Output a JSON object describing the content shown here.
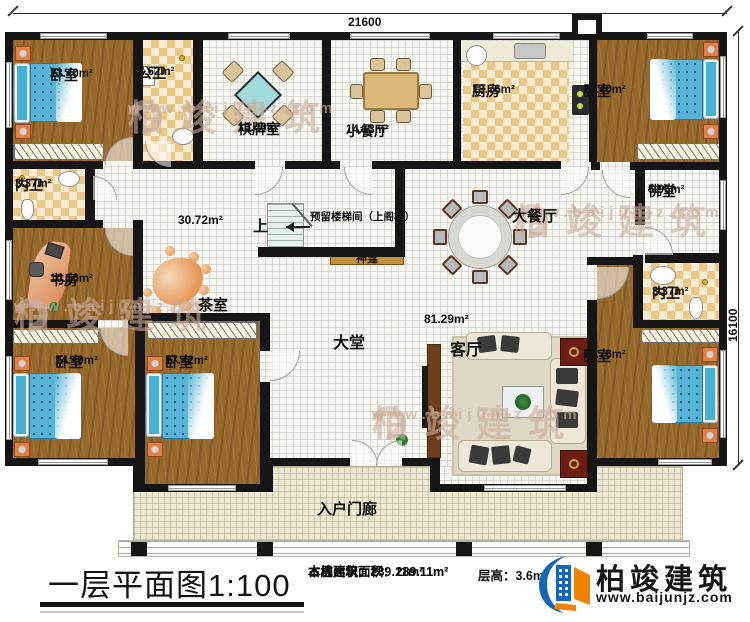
{
  "plan": {
    "dim_top": "21600",
    "dim_right": "16100",
    "up_label": "上",
    "stair_note": "预留楼梯间（上阁楼）",
    "open_area_label": "30.72m²",
    "living_area_label": "81.29m²"
  },
  "rooms": {
    "bedroom_tl": {
      "name": "卧室",
      "area": "13.40m²"
    },
    "public_bath": {
      "name": "公卫",
      "area": "3.62m²"
    },
    "chess_room": {
      "name": "棋牌室",
      "area": "13.40m²"
    },
    "small_dining": {
      "name": "小餐厅",
      "area": "14.13m²"
    },
    "kitchen": {
      "name": "厨房",
      "area": "13.76m²"
    },
    "bedroom_tr": {
      "name": "卧室",
      "area": "13.40m²"
    },
    "inner_bath_left": {
      "name": "内卫",
      "area": "3.37m²"
    },
    "study": {
      "name": "书房",
      "area": "10.10m²"
    },
    "tea_room": {
      "name": "茶室"
    },
    "shrine": {
      "name": "神龛"
    },
    "big_dining": {
      "name": "大餐厅"
    },
    "buddha_hall": {
      "name": "佛堂",
      "area": "5.96m²"
    },
    "inner_bath_right": {
      "name": "内卫",
      "area": "3.37m²"
    },
    "bedroom_bl": {
      "name": "卧室",
      "area": "14.49m²"
    },
    "bedroom_bm": {
      "name": "卧室",
      "area": "17.42m²"
    },
    "bedroom_br": {
      "name": "卧室",
      "area": "16.76m²"
    },
    "lobby": {
      "name": "大堂"
    },
    "living": {
      "name": "客厅"
    },
    "porch": {
      "name": "入户门廊"
    }
  },
  "footer": {
    "title": "一层平面图1:100",
    "stats": [
      "本层建筑面积：289.11m²",
      "本栋建筑面积：289.11m²",
      "占地面积：289.11m²"
    ],
    "floor_height": "层高：3.6m"
  },
  "brand": {
    "name": "柏竣建筑",
    "url": "www.baijunjz.com"
  },
  "watermark": {
    "name": "柏竣建筑",
    "url": "www.baijunjz.com"
  },
  "colors": {
    "wall": "#161616",
    "wood": "#96682c",
    "tile_dark": "#eac888",
    "brand_blue": "#1766b5",
    "brand_orange": "#ef8200"
  }
}
